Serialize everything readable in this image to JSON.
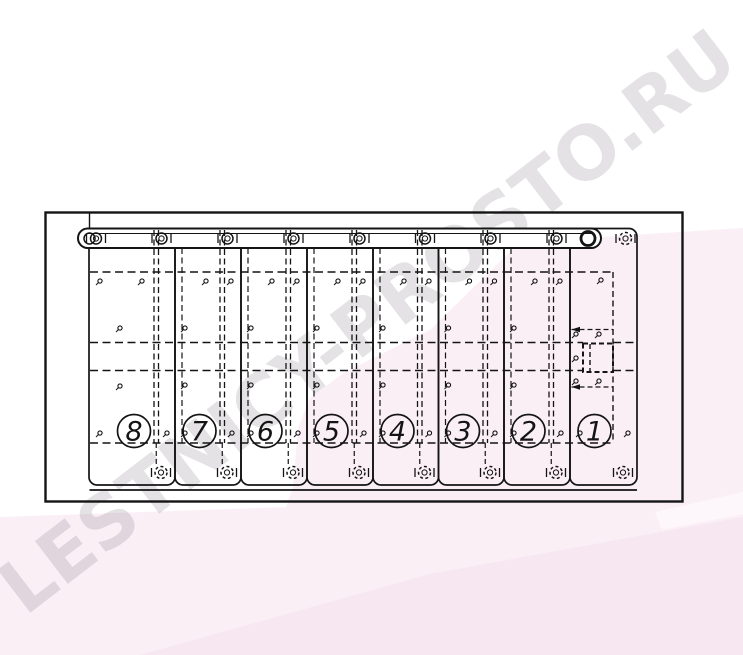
{
  "page": {
    "width_px": 743,
    "height_px": 655
  },
  "watermark": {
    "text": "LESTNICY-PROSTO.RU",
    "color": "rgba(95,82,98,0.17)",
    "angle_deg": -37.5
  },
  "background": {
    "base": "#ffffff",
    "pink_light": "#fbeff6",
    "pink_mid": "#f7e7f0",
    "pink_pale": "#fdf6fa"
  },
  "drawing": {
    "line_color": "#141414",
    "step_labels": [
      "8",
      "7",
      "6",
      "5",
      "4",
      "3",
      "2",
      "1"
    ],
    "plank_edges_x": [
      89,
      175,
      241,
      307,
      373,
      438.5,
      504,
      570,
      637
    ],
    "outer_frame": {
      "x": 45.5,
      "y": 212.5,
      "w": 637,
      "h": 289
    },
    "plank_top_y": 228.5,
    "plank_bottom_y": 485,
    "rail": {
      "x1": 78,
      "x2": 601,
      "top": 228.5,
      "bottom": 248
    },
    "back_line_y": 490,
    "number_circle": {
      "cy": 431,
      "r": 16.5
    }
  }
}
